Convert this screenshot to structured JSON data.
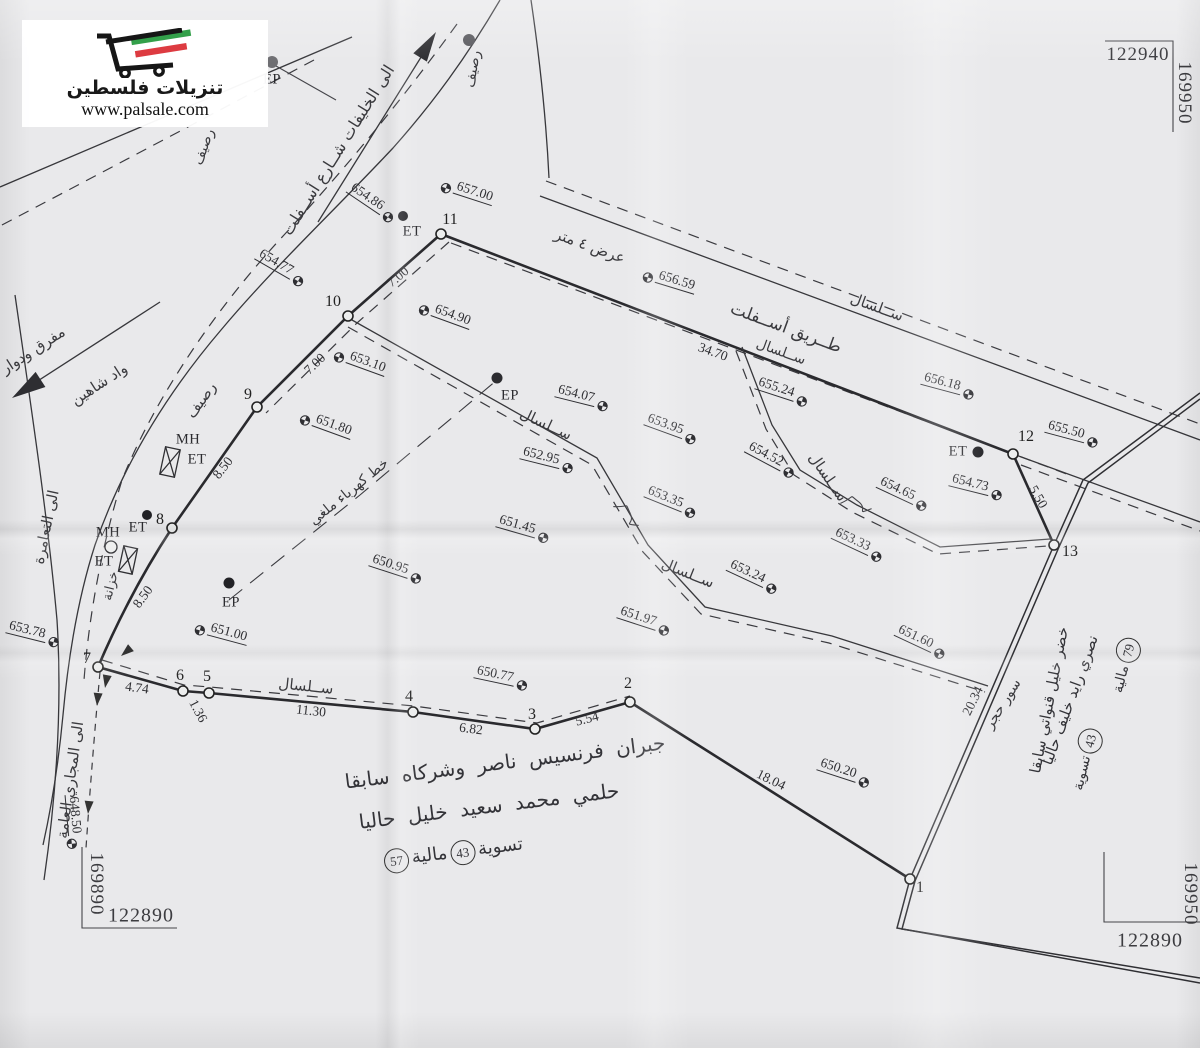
{
  "watermark": {
    "brand": "تنزيلات فلسطين",
    "url": "www.palsale.com",
    "green": "#33a04a",
    "red": "#dd3b41",
    "ink": "#161616"
  },
  "grid": {
    "top_right": {
      "easting": "122940",
      "northing": "169950"
    },
    "bottom_right": {
      "easting": "122890",
      "northing": "169950"
    },
    "bottom_left": {
      "easting": "122890",
      "northing": "169890"
    }
  },
  "owners_center": {
    "line1": "جبران فرنسيس ناصر وشركاه سابقا",
    "line2": "حلمي محمد سعيد خليل حاليا",
    "settle_label": "تسوية",
    "settle_no": "43",
    "fiscal_label": "مالية",
    "fiscal_no": "57"
  },
  "owners_right": {
    "line1": "خضر خليل قنواتي سابقا",
    "line2": "نصري رايد خليف حاليا",
    "fiscal_label": "مالية",
    "fiscal_no": "79",
    "settle_label": "تسوية",
    "settle_no": "43"
  },
  "map": {
    "points": [
      {
        "n": "1",
        "cx": 910,
        "cy": 879,
        "lx": 920,
        "ly": 888
      },
      {
        "n": "2",
        "cx": 630,
        "cy": 702,
        "lx": 628,
        "ly": 684
      },
      {
        "n": "3",
        "cx": 535,
        "cy": 729,
        "lx": 532,
        "ly": 715
      },
      {
        "n": "4",
        "cx": 413,
        "cy": 712,
        "lx": 409,
        "ly": 697
      },
      {
        "n": "5",
        "cx": 209,
        "cy": 693,
        "lx": 207,
        "ly": 677
      },
      {
        "n": "6",
        "cx": 183,
        "cy": 691,
        "lx": 180,
        "ly": 676
      },
      {
        "n": "7",
        "cx": 98,
        "cy": 667,
        "lx": 87,
        "ly": 659
      },
      {
        "n": "8",
        "cx": 172,
        "cy": 528,
        "lx": 160,
        "ly": 520
      },
      {
        "n": "9",
        "cx": 257,
        "cy": 407,
        "lx": 248,
        "ly": 395
      },
      {
        "n": "10",
        "cx": 348,
        "cy": 316,
        "lx": 333,
        "ly": 302
      },
      {
        "n": "11",
        "cx": 441,
        "cy": 234,
        "lx": 450,
        "ly": 220
      },
      {
        "n": "12",
        "cx": 1013,
        "cy": 454,
        "lx": 1026,
        "ly": 437
      },
      {
        "n": "13",
        "cx": 1054,
        "cy": 545,
        "lx": 1070,
        "ly": 552
      }
    ],
    "elevations": [
      {
        "v": "657.00",
        "x": 468,
        "y": 190,
        "r": 18,
        "s": "l"
      },
      {
        "v": "654.86",
        "x": 373,
        "y": 201,
        "r": 34,
        "s": "r"
      },
      {
        "v": "654.77",
        "x": 282,
        "y": 266,
        "r": 30,
        "s": "r"
      },
      {
        "v": "656.59",
        "x": 670,
        "y": 279,
        "r": 17,
        "s": "l"
      },
      {
        "v": "654.90",
        "x": 446,
        "y": 313,
        "r": 20,
        "s": "l"
      },
      {
        "v": "653.10",
        "x": 361,
        "y": 360,
        "r": 20,
        "s": "l"
      },
      {
        "v": "656.18",
        "x": 949,
        "y": 384,
        "r": 15,
        "s": "r"
      },
      {
        "v": "655.24",
        "x": 783,
        "y": 390,
        "r": 18,
        "s": "r"
      },
      {
        "v": "655.50",
        "x": 1073,
        "y": 432,
        "r": 15,
        "s": "r"
      },
      {
        "v": "651.80",
        "x": 327,
        "y": 423,
        "r": 20,
        "s": "l"
      },
      {
        "v": "654.07",
        "x": 583,
        "y": 396,
        "r": 14,
        "s": "r"
      },
      {
        "v": "653.95",
        "x": 672,
        "y": 427,
        "r": 20,
        "s": "r"
      },
      {
        "v": "652.95",
        "x": 548,
        "y": 458,
        "r": 14,
        "s": "r"
      },
      {
        "v": "654.52",
        "x": 772,
        "y": 458,
        "r": 28,
        "s": "r"
      },
      {
        "v": "654.65",
        "x": 904,
        "y": 492,
        "r": 25,
        "s": "r"
      },
      {
        "v": "654.73",
        "x": 977,
        "y": 485,
        "r": 14,
        "s": "r"
      },
      {
        "v": "653.35",
        "x": 672,
        "y": 500,
        "r": 22,
        "s": "r"
      },
      {
        "v": "651.45",
        "x": 524,
        "y": 527,
        "r": 16,
        "s": "r"
      },
      {
        "v": "653.33",
        "x": 859,
        "y": 543,
        "r": 25,
        "s": "r"
      },
      {
        "v": "650.95",
        "x": 397,
        "y": 567,
        "r": 18,
        "s": "r"
      },
      {
        "v": "653.24",
        "x": 754,
        "y": 575,
        "r": 25,
        "s": "r"
      },
      {
        "v": "651.97",
        "x": 645,
        "y": 619,
        "r": 18,
        "s": "r"
      },
      {
        "v": "651.60",
        "x": 922,
        "y": 640,
        "r": 25,
        "s": "r"
      },
      {
        "v": "651.00",
        "x": 222,
        "y": 631,
        "r": 15,
        "s": "l"
      },
      {
        "v": "653.78",
        "x": 34,
        "y": 632,
        "r": 14,
        "s": "r"
      },
      {
        "v": "650.77",
        "x": 502,
        "y": 676,
        "r": 12,
        "s": "r"
      },
      {
        "v": "650.20",
        "x": 845,
        "y": 771,
        "r": 18,
        "s": "r"
      },
      {
        "v": "648.50",
        "x": 75,
        "y": 822,
        "r": 85,
        "s": "r"
      }
    ],
    "measurements": [
      {
        "v": "7.00",
        "x": 398,
        "y": 277,
        "r": -40
      },
      {
        "v": "7.00",
        "x": 315,
        "y": 364,
        "r": -44
      },
      {
        "v": "8.50",
        "x": 223,
        "y": 468,
        "r": -52
      },
      {
        "v": "8.50",
        "x": 143,
        "y": 597,
        "r": -54
      },
      {
        "v": "34.70",
        "x": 713,
        "y": 352,
        "r": 20
      },
      {
        "v": "5.50",
        "x": 1038,
        "y": 497,
        "r": 60
      },
      {
        "v": "20.34",
        "x": 973,
        "y": 701,
        "r": -64
      },
      {
        "v": "4.74",
        "x": 137,
        "y": 688,
        "r": 8
      },
      {
        "v": "1.36",
        "x": 198,
        "y": 711,
        "r": 62
      },
      {
        "v": "11.30",
        "x": 311,
        "y": 711,
        "r": 6
      },
      {
        "v": "6.82",
        "x": 471,
        "y": 729,
        "r": 7
      },
      {
        "v": "5.54",
        "x": 587,
        "y": 719,
        "r": -14
      },
      {
        "v": "18.04",
        "x": 771,
        "y": 780,
        "r": 26
      }
    ],
    "labels": [
      {
        "t": "الى الخليفات شــارع أســفلت",
        "x": 338,
        "y": 150,
        "r": -58,
        "fs": 16
      },
      {
        "t": "عرض ٤ متر",
        "x": 590,
        "y": 246,
        "r": 20,
        "fs": 15
      },
      {
        "t": "طــريق أســفلت",
        "x": 786,
        "y": 328,
        "r": 20,
        "fs": 17
      },
      {
        "t": "ســلسال",
        "x": 877,
        "y": 307,
        "r": 20,
        "fs": 15
      },
      {
        "t": "ســلسال",
        "x": 781,
        "y": 352,
        "r": 20,
        "fs": 14
      },
      {
        "t": "ســلسال",
        "x": 546,
        "y": 424,
        "r": 25,
        "fs": 15
      },
      {
        "t": "ســلسال",
        "x": 688,
        "y": 573,
        "r": 22,
        "fs": 15
      },
      {
        "t": "ســلسال",
        "x": 828,
        "y": 477,
        "r": 55,
        "fs": 15
      },
      {
        "t": "ســلسال",
        "x": 306,
        "y": 686,
        "r": 6,
        "fs": 15
      },
      {
        "t": "رصيف",
        "x": 204,
        "y": 147,
        "r": -70,
        "fs": 14
      },
      {
        "t": "رصيف",
        "x": 473,
        "y": 69,
        "r": -80,
        "fs": 14
      },
      {
        "t": "رصيف",
        "x": 201,
        "y": 400,
        "r": -54,
        "fs": 15
      },
      {
        "t": "مفرق ودوار",
        "x": 33,
        "y": 350,
        "r": -33,
        "fs": 15
      },
      {
        "t": "واد شاهين",
        "x": 99,
        "y": 384,
        "r": -33,
        "fs": 15
      },
      {
        "t": "الى التعامرة",
        "x": 46,
        "y": 527,
        "r": -78,
        "fs": 15
      },
      {
        "t": "الى المجاري العامة",
        "x": 70,
        "y": 780,
        "r": -82,
        "fs": 15
      },
      {
        "t": "خزانة",
        "x": 111,
        "y": 586,
        "r": -76,
        "fs": 13
      },
      {
        "t": "خط كهرباء ملغي",
        "x": 349,
        "y": 492,
        "r": -39,
        "fs": 14
      },
      {
        "t": "سور حجر",
        "x": 1003,
        "y": 704,
        "r": -58,
        "fs": 14
      }
    ],
    "codes": [
      {
        "t": "ET",
        "x": 412,
        "y": 232
      },
      {
        "t": "ET",
        "x": 197,
        "y": 460
      },
      {
        "t": "ET",
        "x": 138,
        "y": 528
      },
      {
        "t": "ET",
        "x": 104,
        "y": 562
      },
      {
        "t": "ET",
        "x": 958,
        "y": 452
      },
      {
        "t": "MH",
        "x": 188,
        "y": 440
      },
      {
        "t": "MH",
        "x": 108,
        "y": 533
      },
      {
        "t": "EP",
        "x": 272,
        "y": 80
      },
      {
        "t": "EP",
        "x": 510,
        "y": 396
      },
      {
        "t": "EP",
        "x": 231,
        "y": 603
      }
    ],
    "dots": [
      {
        "x": 403,
        "y": 216,
        "r": 5,
        "c": "#222226"
      },
      {
        "x": 147,
        "y": 515,
        "r": 5,
        "c": "#222226"
      },
      {
        "x": 978,
        "y": 452,
        "r": 5.5,
        "c": "#222226"
      },
      {
        "x": 272,
        "y": 62,
        "r": 6,
        "c": "#6e6e72"
      },
      {
        "x": 497,
        "y": 378,
        "r": 5.5,
        "c": "#2c2c30"
      },
      {
        "x": 229,
        "y": 583,
        "r": 5.5,
        "c": "#222226"
      },
      {
        "x": 469,
        "y": 40,
        "r": 6,
        "c": "#59595e"
      }
    ]
  }
}
